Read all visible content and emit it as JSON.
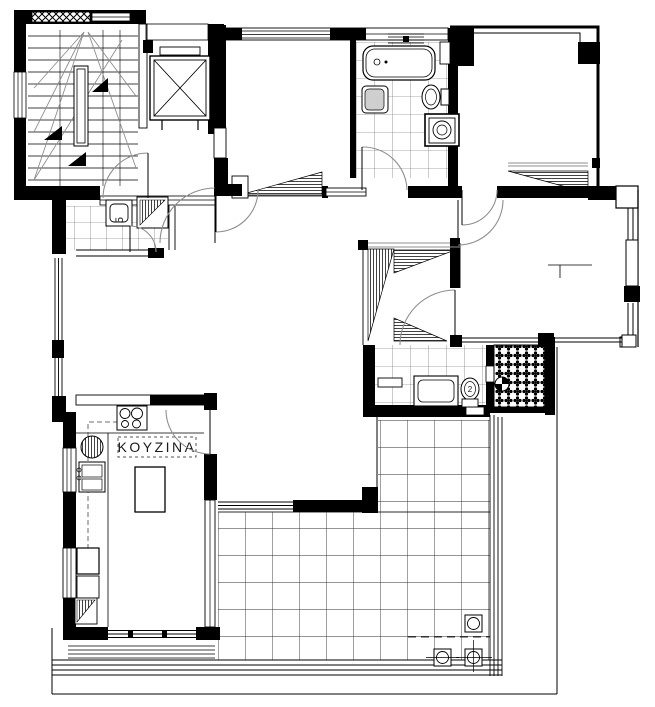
{
  "plan": {
    "labels": {
      "kitchen": "KOYZINA",
      "room_tag": "5",
      "fixture_tag": "2"
    },
    "colors": {
      "ink": "#000000",
      "paper": "#ffffff",
      "arc_gray": "#8f8f8f",
      "grid_gray": "#3a3a3a"
    },
    "fixtures": [
      "staircase",
      "elevator",
      "bathtub",
      "washbasin",
      "toilet",
      "washing-machine",
      "shower-tray",
      "kitchen-stove",
      "kitchen-sink",
      "kitchen-island",
      "refrigerator",
      "wardrobe",
      "floor-drain",
      "pebble-lightwell",
      "terrace-tiles"
    ]
  }
}
